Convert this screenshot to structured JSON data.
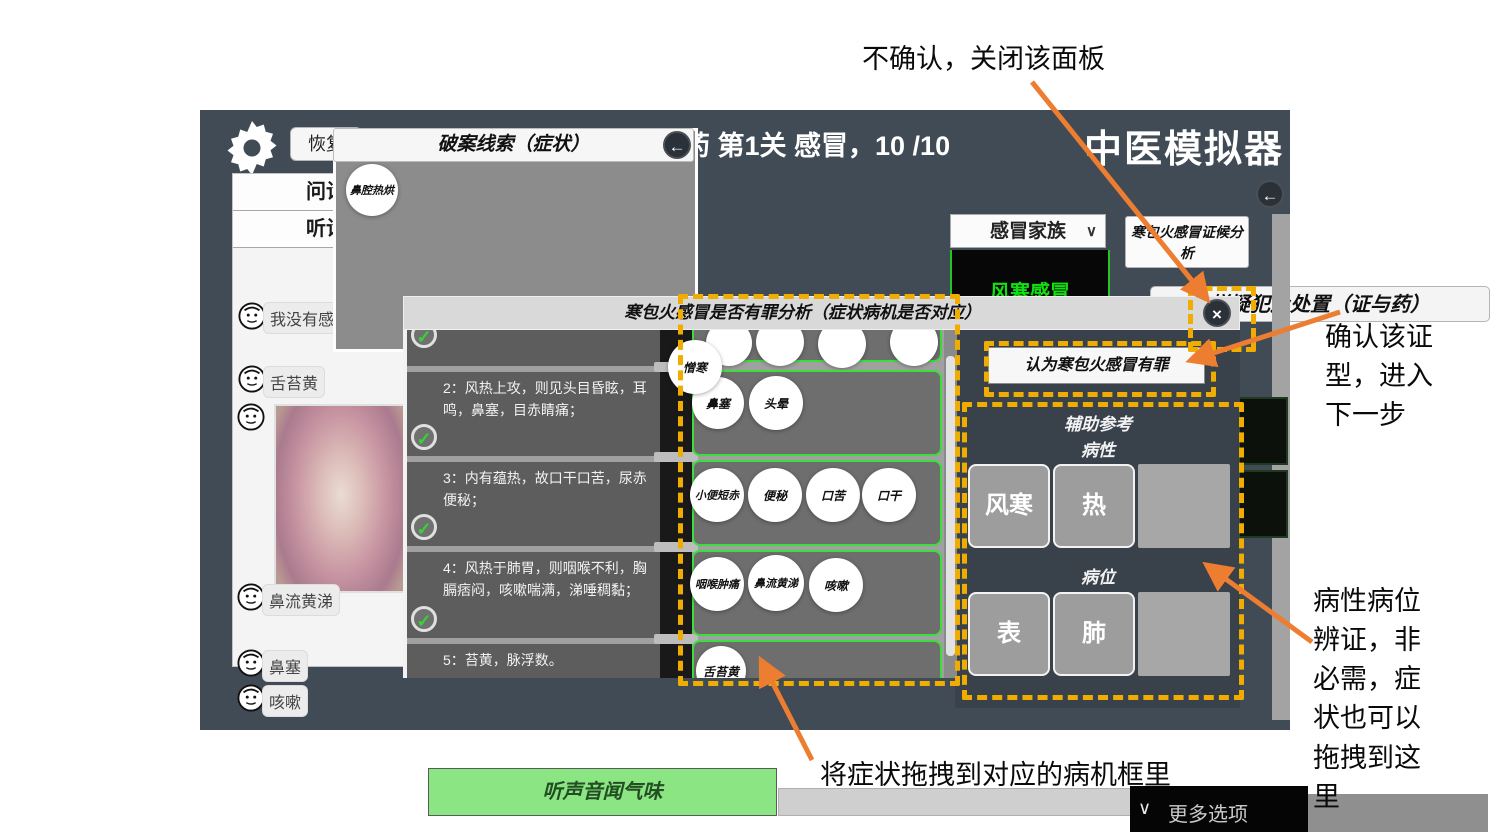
{
  "annotations": {
    "close_note": "不确认，关闭该面板",
    "confirm_note": "确认该证型，进入下一步",
    "aux_note": "病性病位辨证，非必需，症状也可以拖拽到这里",
    "drag_note": "将症状拖拽到对应的病机框里"
  },
  "topbar": {
    "restore": "恢复",
    "level": "药 第1关 感冒，10 /10",
    "app_title": "中医模拟器"
  },
  "clue_panel": {
    "title": "破案线索（症状）",
    "back_icon": "back-arrow",
    "clue": "鼻腔热烘"
  },
  "chat": {
    "tab1": "问诊",
    "tab2": "听诊",
    "messages": [
      "我没有感冒",
      "舌苔黄",
      "鼻流黄涕",
      "鼻塞",
      "咳嗽"
    ],
    "listen_button": "听声音闻气味"
  },
  "suspect_panel": {
    "title": "嫌疑犯及处置（证与药）",
    "family": "感冒家族",
    "family_chevron": "∨",
    "highlighted": "风寒感冒",
    "analysis_card": "寒包火感冒证候分析"
  },
  "dialog": {
    "title": "寒包火感冒是否有罪分析（症状病机是否对应）",
    "close_icon": "×",
    "items": [
      "2：风热上攻，则见头目昏眩，耳鸣，鼻塞，目赤睛痛；",
      "3：内有蕴热，故口干口苦，尿赤便秘；",
      "4：风热于肺胃，则咽喉不利，胸膈痞闷，咳嗽喘满，涕唾稠黏；",
      "5：苔黄，脉浮数。"
    ],
    "check_glyph": "✓",
    "zone_symptoms": [
      [
        "憎寒"
      ],
      [
        "鼻塞",
        "头晕"
      ],
      [
        "小便短赤",
        "便秘",
        "口苦",
        "口干"
      ],
      [
        "咽喉肿痛",
        "鼻流黄涕",
        "咳嗽"
      ],
      [
        "舌苔黄"
      ]
    ],
    "confirm_button": "认为寒包火感冒有罪",
    "aux_title": "辅助参考",
    "nature_label": "病性",
    "nature_options": [
      "风寒",
      "热"
    ],
    "location_label": "病位",
    "location_options": [
      "表",
      "肺"
    ],
    "more_options": "更多选项",
    "more_chevron": "∨"
  },
  "colors": {
    "highlight_dash": "#f0ad00",
    "arrow_orange": "#ed7d31",
    "zone_green": "#3ddd3d",
    "suspect_green": "#11e011",
    "listen_green": "#8be583"
  }
}
